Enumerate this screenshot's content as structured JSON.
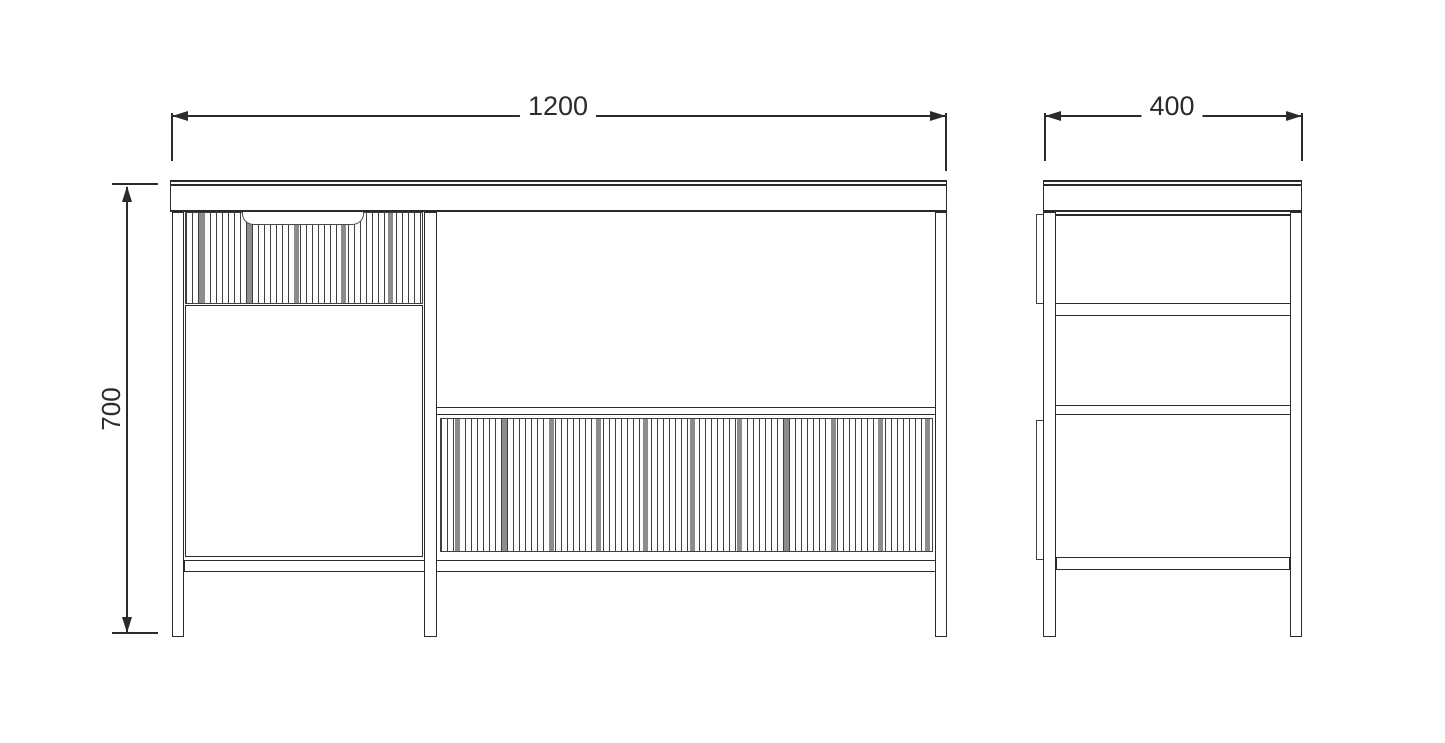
{
  "document": {
    "type": "technical-drawing",
    "subject": "cabinet orthographic views (front and side)"
  },
  "dimensions": {
    "front_width": "1200",
    "front_height": "700",
    "side_depth": "400"
  },
  "colors": {
    "background": "#ffffff",
    "line": "#2b2b2b",
    "flute_gray": "#8c8c8c",
    "panel_fill": "#ffffff"
  }
}
